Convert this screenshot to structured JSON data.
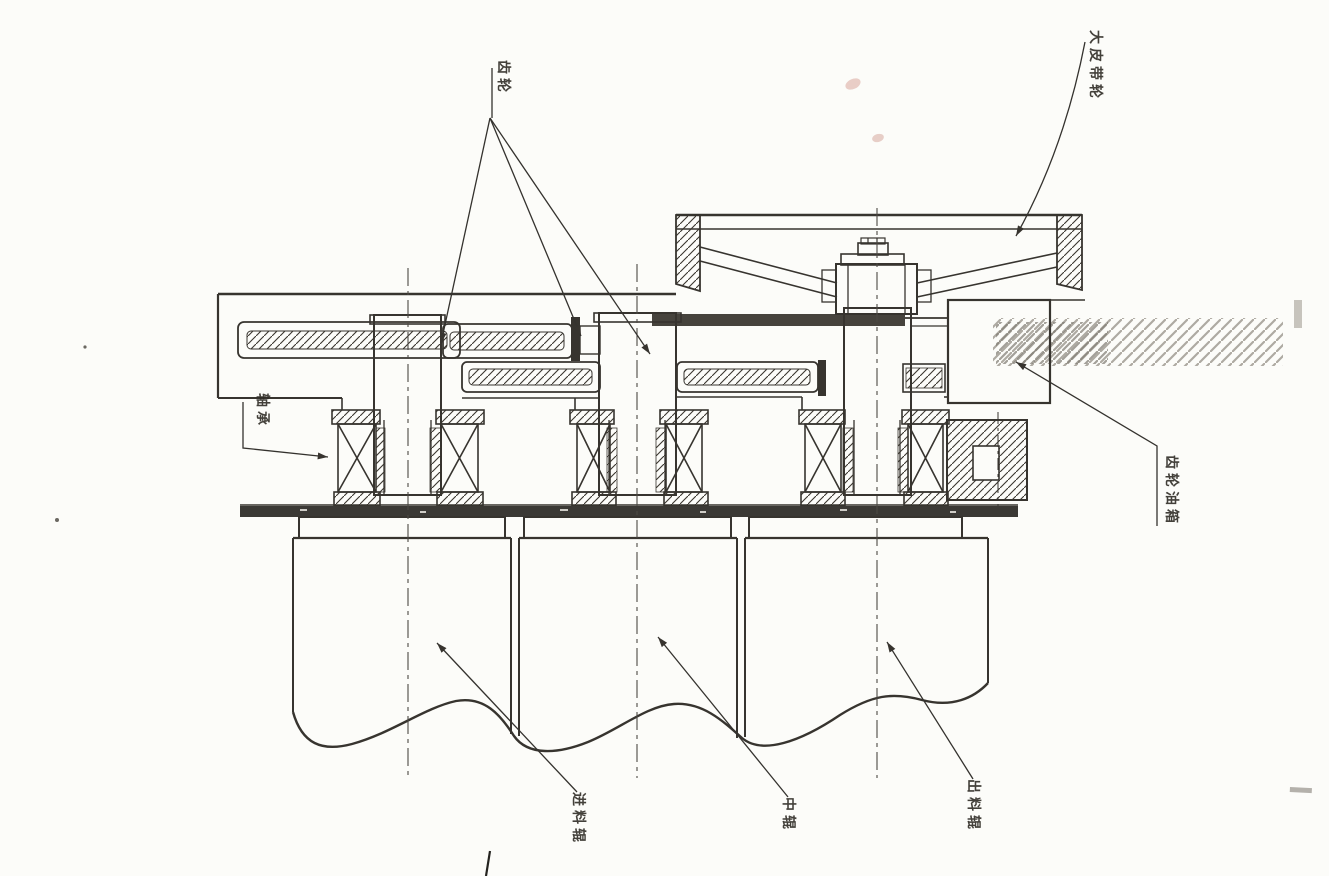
{
  "drawing": {
    "ink_color": "#37342f",
    "paper_color": "#fcfcf9",
    "labels": {
      "gear": "齿轮",
      "big_belt_pulley": "大皮带轮",
      "bearing": "轴承",
      "gear_oil_box": "齿轮油箱",
      "feed_roller": "进料辊",
      "middle_roller": "中辊",
      "discharge_roller": "出料辊"
    }
  }
}
